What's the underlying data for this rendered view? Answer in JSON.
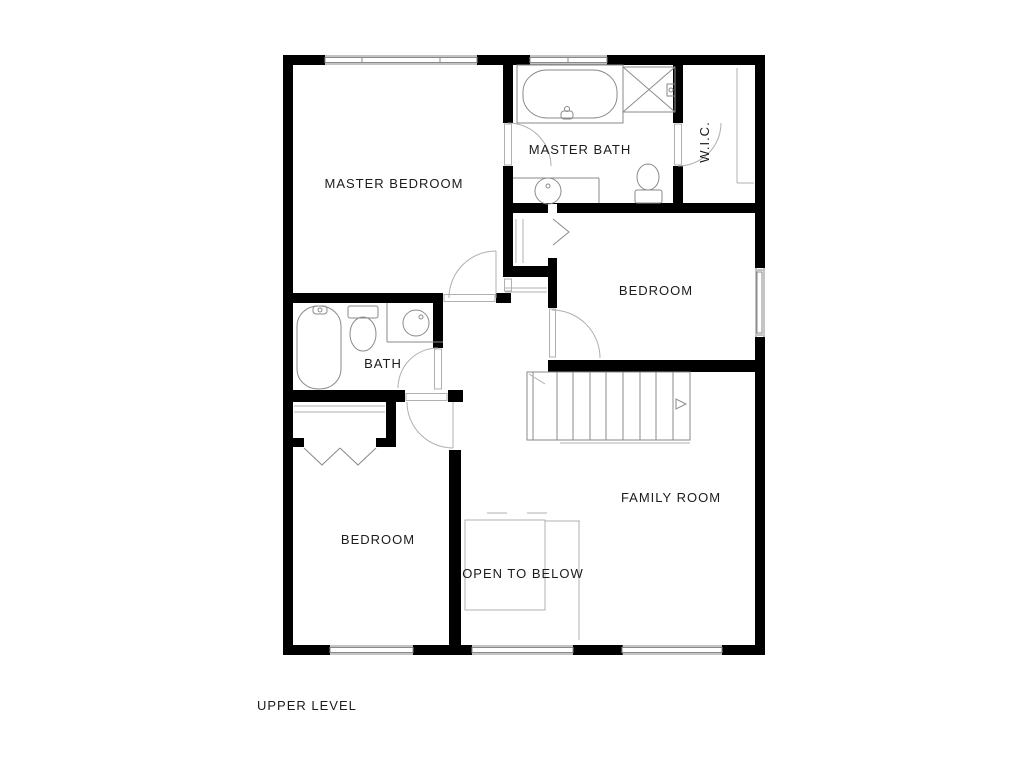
{
  "plan": {
    "level_label": "UPPER LEVEL",
    "rooms": {
      "master_bedroom": "MASTER BEDROOM",
      "master_bath": "MASTER BATH",
      "wic": "W.I.C.",
      "bedroom_right": "BEDROOM",
      "bedroom_left": "BEDROOM",
      "bath": "BATH",
      "family_room": "FAMILY ROOM",
      "open_to_below": "OPEN TO BELOW"
    },
    "fixtures": [
      "garden-tub-icon",
      "shower-icon",
      "toilet-icon",
      "sink-icon",
      "bathtub-icon",
      "toilet-icon",
      "sink-icon",
      "stairs-up-icon",
      "stair-direction-arrow-icon",
      "bifold-closet-door-icon",
      "closet-shelf-icon",
      "door-swing-arc-icon",
      "window-icon"
    ],
    "colors": {
      "wall": "#000000",
      "fixture_line": "#8a8a8a",
      "faint_line": "#b0b0b0",
      "text": "#1c1c1c",
      "background": "#ffffff"
    }
  }
}
